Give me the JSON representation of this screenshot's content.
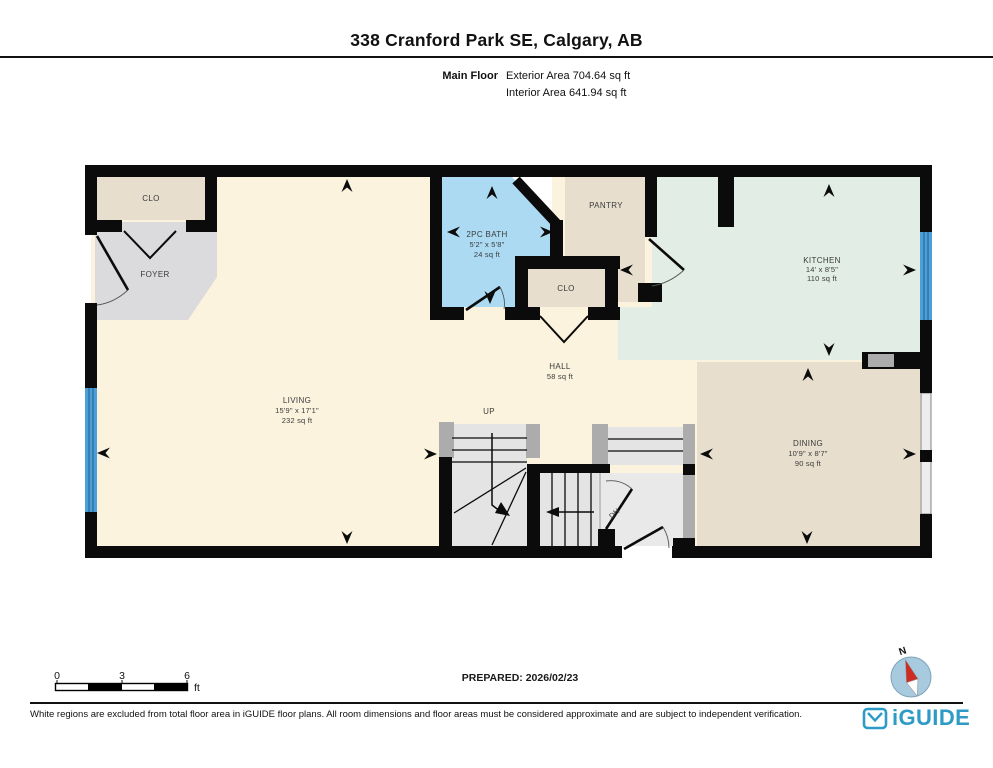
{
  "header": {
    "title": "338 Cranford Park SE, Calgary, AB",
    "floor_label": "Main Floor",
    "exterior_area": "Exterior Area 704.64 sq ft",
    "interior_area": "Interior Area 641.94 sq ft"
  },
  "rooms": {
    "living": {
      "name": "LIVING",
      "dims": "15'9\" x 17'1\"",
      "area": "232 sq ft"
    },
    "kitchen": {
      "name": "KITCHEN",
      "dims": "14' x 8'5\"",
      "area": "110 sq ft"
    },
    "dining": {
      "name": "DINING",
      "dims": "10'9\" x 8'7\"",
      "area": "90 sq ft"
    },
    "bath": {
      "name": "2PC BATH",
      "dims": "5'2\" x 5'8\"",
      "area": "24 sq ft"
    },
    "hall": {
      "name": "HALL",
      "area": "58 sq ft"
    },
    "foyer": {
      "name": "FOYER"
    },
    "pantry": {
      "name": "PANTRY"
    },
    "closet_entry": {
      "name": "CLO"
    },
    "closet_hall": {
      "name": "CLO"
    },
    "stair_up_label": "UP",
    "stair_down_label": "DN"
  },
  "scale_bar": {
    "tick0": "0",
    "tick3": "3",
    "tick6": "6",
    "unit": "ft"
  },
  "prepared": "PREPARED: 2026/02/23",
  "compass": {
    "north_label": "N"
  },
  "footer": {
    "disclaimer": "White regions are excluded from total floor area in iGUIDE floor plans. All room dimensions and floor areas must be considered approximate and are subject to independent verification.",
    "brand": "iGUIDE"
  },
  "colors": {
    "wall": "#0b0b0b",
    "living_cream": "#fbf3de",
    "foyer_gray": "#dbdbdd",
    "closet_beige": "#e7decd",
    "bath_blue": "#abdaf2",
    "kitchen_mint": "#e2ede5",
    "stair_gray": "#e4e4e4",
    "window_blue": "#4d9fd8",
    "brand_blue": "#2e9bc7",
    "compass_red": "#ce2b22",
    "compass_disc": "#a7cadf"
  }
}
